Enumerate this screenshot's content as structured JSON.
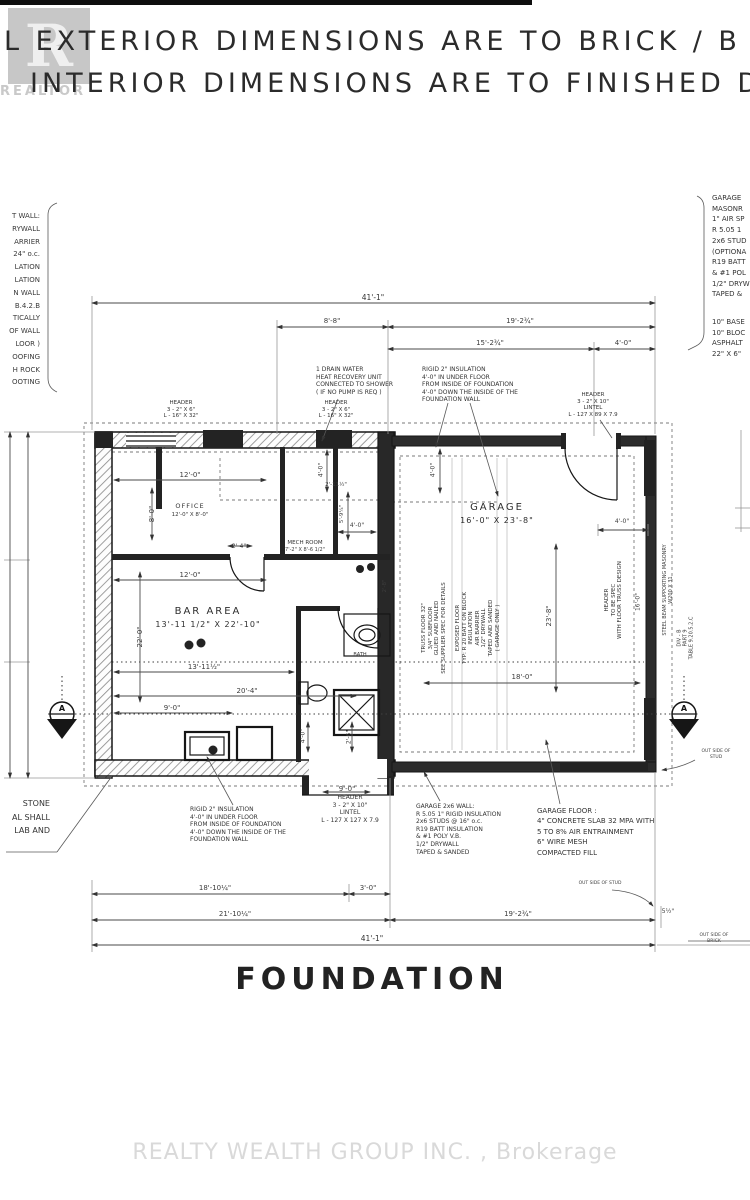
{
  "header": {
    "line1": "L EXTERIOR DIMENSIONS ARE TO BRICK / B",
    "line2": "INTERIOR DIMENSIONS ARE TO FINISHED DR"
  },
  "logo": {
    "letter": "R",
    "caption": "REALTOR"
  },
  "side_notes": {
    "left_column": "T WALL:\nRYWALL\nARRIER\n24\" o.c.\nLATION\nLATION\nN WALL\nB.4.2.B\nTICALLY\nOF WALL\nLOOR )\nOOFING\nH ROCK\nOOTING",
    "right_top": "GARAGE\nMASONR\n1\" AIR SP\nR 5.05 1\n2x6 STUD\n(OPTIONA\nR19 BATT\n& #1 POL\n1/2\" DRYW\nTAPED &",
    "right_bottom": "10\" BASE\n10\" BLOC\nASPHALT\n22\" X 6\""
  },
  "plan_notes": {
    "drain": "1 DRAIN WATER\nHEAT RECOVERY UNIT\nCONNECTED TO SHOWER\n( IF NO PUMP IS REQ )",
    "rigid_top": "RIGID 2\" INSULATION\n4'-0\" IN UNDER FLOOR\nFROM INSIDE OF FOUNDATION\n4'-0\" DOWN THE INSIDE OF THE\nFOUNDATION WALL",
    "header_left": "HEADER\n3 - 2\" X 6\"\nL - 16\" X 32\"",
    "header_mid": "HEADER\n3 - 2\" X 6\"\nL - 16\" X 32\"",
    "header_right": "HEADER\n3 - 2\" X 10\"\nLINTEL\nL - 127 X 89 X 7.9",
    "truss": "TRUSS FLOOR 32\"\n3/4\" SUBFLOOR\nGLUED AND NAILED\nSEE SUPPLIER SPEC FOR DETAILS",
    "exposed": "EXPOSED FLOOR\nTYP: R 20 BATT ON BLOCK\nINSULATION\nAIR BARRIER\n1/2\" DRYWALL\nTAPED AND SANDED\n( GARAGE ONLY )",
    "header_vert": "HEADER\nTO BE SPEC\nWITH FLOOR TRUSS DESIGN",
    "steel": "STEEL BEAM SUPPORTING MASONRY\nW200 X 31",
    "code": "DIV - B\nPART 9\nTABLE 9.20.5.2.C",
    "rigid_bottom": "RIGID 2\" INSULATION\n4'-0\" IN UNDER FLOOR\nFROM INSIDE OF FOUNDATION\n4'-0\" DOWN THE INSIDE OF THE\nFOUNDATION WALL",
    "header_bottom": "HEADER\n3 - 2\" X 10\"\nLINTEL\nL - 127 X 127 X 7.9",
    "garage_wall": "GARAGE 2x6 WALL:\nR 5.05 1\" RIGID INSULATION\n2x6 STUDS @ 16\" o.c.\nR19 BATT INSULATION\n& #1 POLY V.B.\n1/2\" DRYWALL\nTAPED & SANDED",
    "garage_floor": "GARAGE FLOOR :\n4\" CONCRETE SLAB 32 MPA WITH\n5 TO 8% AIR ENTRAINMENT\n6\" WIRE MESH\nCOMPACTED FILL",
    "stone": "STONE\nAL SHALL\nLAB AND",
    "out_stud": "OUT SIDE OF STUD",
    "out_stud2": "OUT SIDE OF STUD",
    "out_brick": "OUT SIDE OF BRICK"
  },
  "rooms": {
    "office": {
      "name": "OFFICE",
      "size": "12'-0\" X 8'-0\""
    },
    "mech": {
      "name": "MECH ROOM",
      "size": "7'-2\" X 8'-6 1/2\""
    },
    "bar": {
      "name": "BAR AREA",
      "size": "13'-11 1/2\" X 22'-10\""
    },
    "bath": {
      "name": "BATH"
    },
    "garage": {
      "name": "GARAGE",
      "size": "16'-0\" X 23'-8\""
    }
  },
  "dims": {
    "top_overall": "41'-1\"",
    "top_8_8": "8'-8\"",
    "top_19_2": "19'-2¾\"",
    "top_15_2": "15'-2¾\"",
    "top_4_0": "4'-0\"",
    "office_w": "12'-0\"",
    "office_h": "8'-0\"",
    "d2_4": "2'-4\"",
    "hall_12": "12'-0\"",
    "bar_h": "22'-0\"",
    "bar_w": "13'-11½\"",
    "d20_4": "20'-4\"",
    "d9_0": "9'-0\"",
    "m4a": "4'-0\"",
    "d2_11": "2'-11½\"",
    "d5_9": "5'-9¼\"",
    "m4b": "4'-0\"",
    "door2_8": "2'-8\"",
    "g4a": "4'-0\"",
    "g4b": "4'-0\"",
    "g23_8": "23'-8\"",
    "g18_0": "18'-0\"",
    "g16_0": "16'-0\"",
    "b4_0": "4'-0\"",
    "b2_6": "2'-6\"",
    "open9": "9'-0\"",
    "bot_18_10": "18'-10¼\"",
    "bot_3_0": "3'-0\"",
    "bot_21_10": "21'-10¼\"",
    "bot_19_2": "19'-2¾\"",
    "bot_5h": "5½\"",
    "bot_overall": "41'-1\""
  },
  "section": {
    "letter": "A"
  },
  "title": "FOUNDATION",
  "watermark": "REALTY WEALTH GROUP INC. , Brokerage"
}
